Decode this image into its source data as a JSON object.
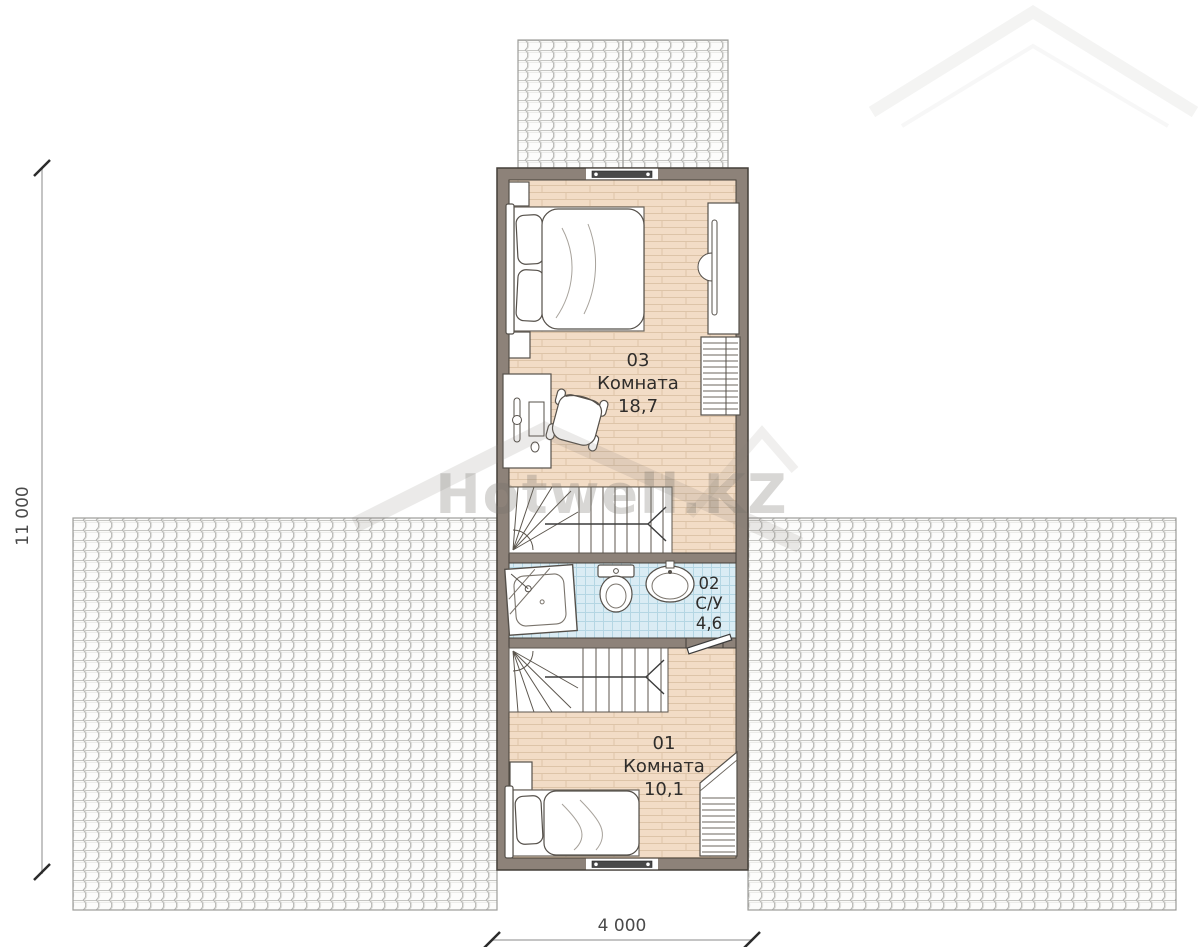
{
  "watermark": {
    "brand": "Hotwell.KZ"
  },
  "dimensions": {
    "height_total": "11 000",
    "width_total": "4 000"
  },
  "rooms": [
    {
      "number": "03",
      "name": "Комната",
      "area": "18,7"
    },
    {
      "number": "02",
      "name": "С/У",
      "area": "4,6"
    },
    {
      "number": "01",
      "name": "Комната",
      "area": "10,1"
    }
  ],
  "furniture_icons": [
    "double-bed-icon",
    "single-bed-icon",
    "nightstand-icon",
    "desk-icon",
    "office-chair-icon",
    "tv-dresser-icon",
    "wardrobe-icon",
    "shower-icon",
    "toilet-icon",
    "sink-icon",
    "stairs-icon",
    "window-icon",
    "door-icon",
    "roof-tiles-icon"
  ],
  "colors": {
    "wall": "#8d8279",
    "wood_floor": "#f2dcc6",
    "tile_floor": "#daecf4",
    "roof_hatch": "#b8b8b5",
    "dimension_text": "#4a4a4a"
  }
}
